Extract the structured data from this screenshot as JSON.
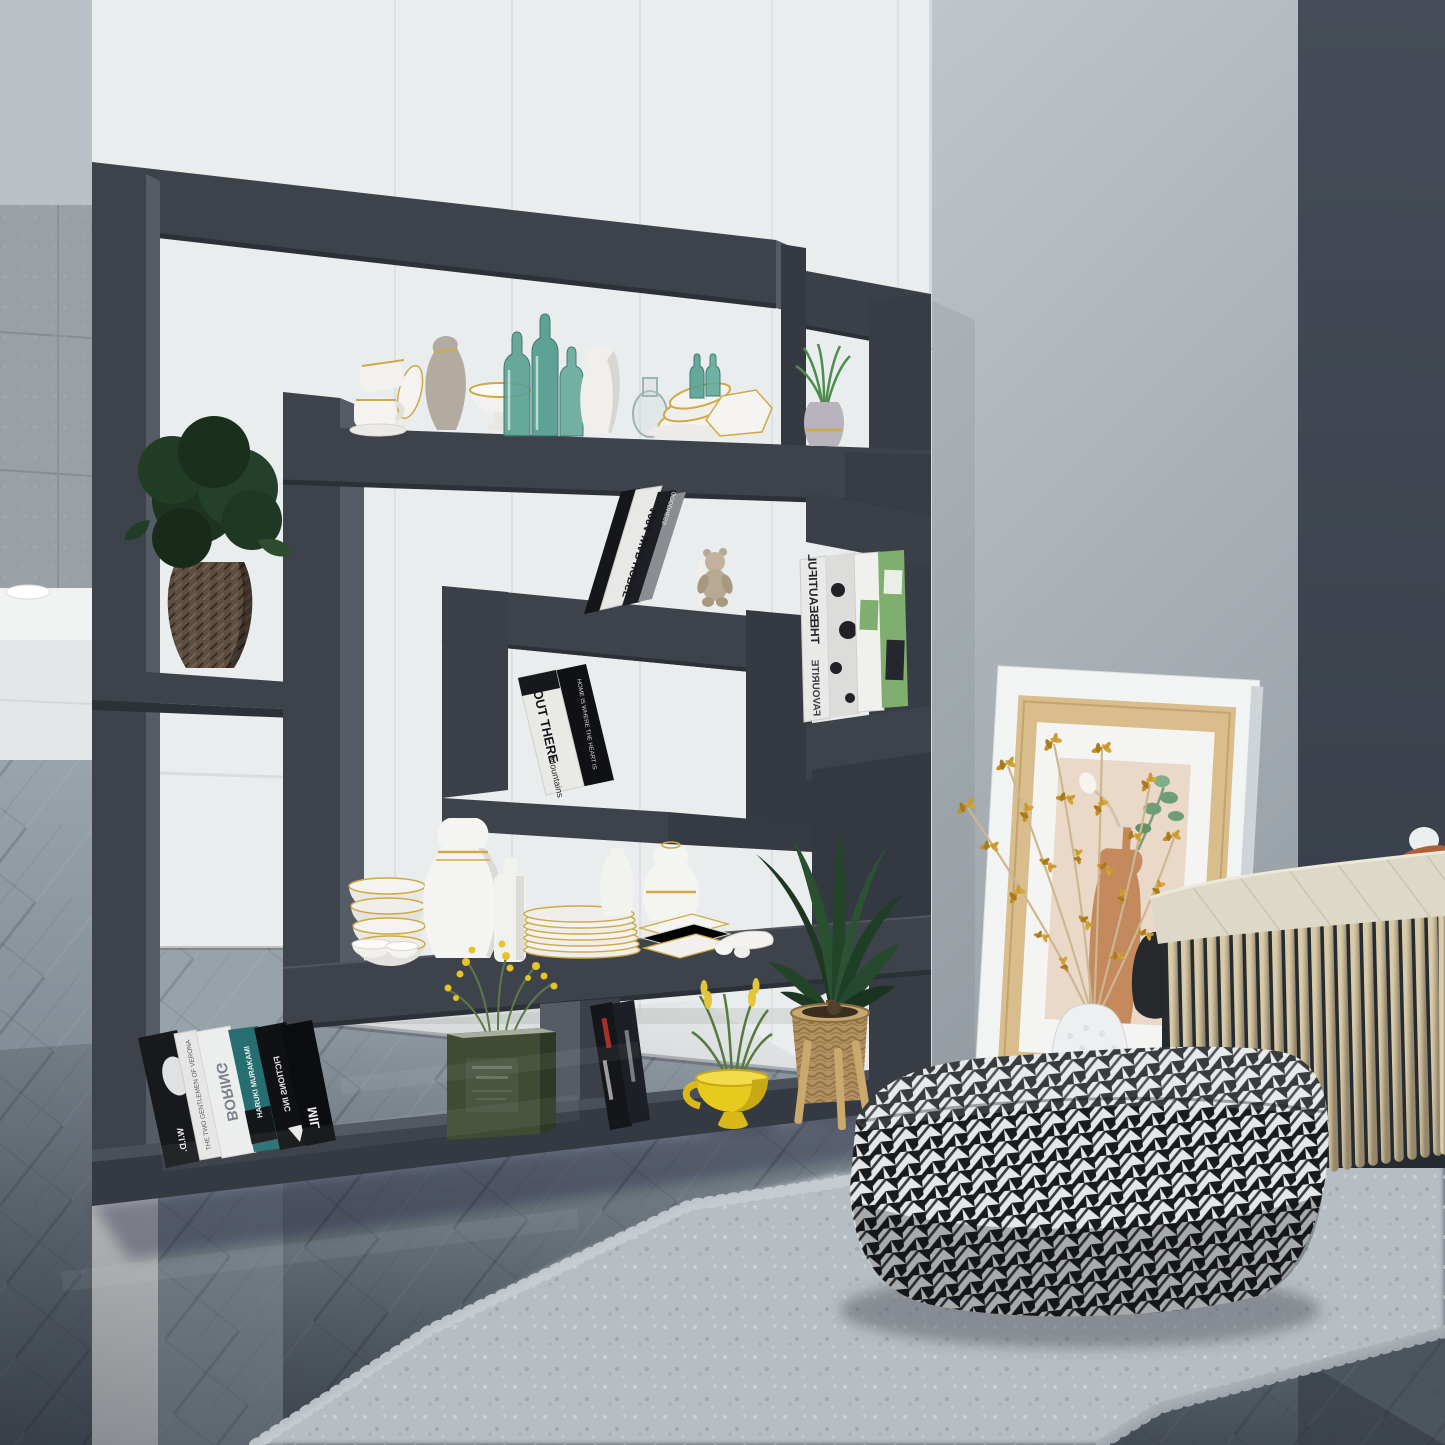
{
  "scene": {
    "description": "Modern living room interior with a dark gray geometric cube room-divider shelf holding ceramics, teal glass bottles, books and plants; beside it a leaning framed botanical print, dried ochre flowers in a white vase, a beige rope bench with cream cushion, a black-and-white houndstooth pouf and a gray shag rug on diagonal herringbone wood flooring",
    "width_px": 1445,
    "height_px": 1445
  },
  "palette": {
    "shelf_front": "#3e434b",
    "shelf_side": "#565c66",
    "shelf_dark": "#2c3037",
    "wall_white": "#eaedee",
    "wall_concrete": "#99a0a6",
    "wall_gray_right": "#b6bdc3",
    "wall_dark_band": "#39404a",
    "floor_far": "#97a1aa",
    "floor_near": "#59626c",
    "rug": "#b7bec3",
    "gold_accent": "#c9a23f",
    "teal_glass": "#57a294",
    "yellow_cup": "#e8ca1e",
    "terracotta": "#c28057",
    "basket": "#b2915f",
    "rope": "#c6b999",
    "cushion": "#ddd8c8",
    "rust_pillow": "#b06036",
    "houndstooth_black": "#1a1b1f",
    "houndstooth_white": "#e4e7e8"
  },
  "books": {
    "y1984": "1984",
    "war_horse": "WAR HORSE",
    "goodness": "GOODNESS",
    "out_there": "OUT THERE",
    "mountains": "Mountains",
    "home_heart": "HOME IS WHERE THE HEART IS",
    "beautiful": "BEAUTIFUL",
    "the": "THE",
    "favourite": "FAVOURITE",
    "boring": "BORING",
    "gentlemen": "THE TWO GENTLEMEN OF VERONA",
    "murakami": "HARUKI MURAKAMI",
    "fictions": "FICTIONS INC",
    "mil": "MIL",
    "wid": "W.I.D."
  },
  "objects": {
    "shelf": "dark gray interlocking-squares shelf room divider",
    "woven_vase": "brown woven vase with dark green plant",
    "top_shelf_items": "white teacups, taupe pitcher, pedestal bowl, teal glass bottles, white jug, glass carafe, gold-rim bowls, hexagonal dish, grass in gray vase",
    "ceramics_shelf": "white and gold vases, bowls, plate stack, square dishes",
    "teddy_bear": "small beige teddy bear figurine",
    "green_tin": "olive green tin with yellow wildflowers",
    "yellow_cup": "yellow footed cup with grass plant",
    "palm_plant": "palm plant in wicker basket on wooden stand",
    "picture_frame": "leaning white and wood frame with vase illustration",
    "dried_flowers": "dried ochre flower branches in white vase",
    "rope_bench": "beige rope-strand bench with cream cushion and rust pillow",
    "pouf": "black and white houndstooth square pouf",
    "rug": "light gray shag rug",
    "floor": "gray herringbone wood floor"
  }
}
